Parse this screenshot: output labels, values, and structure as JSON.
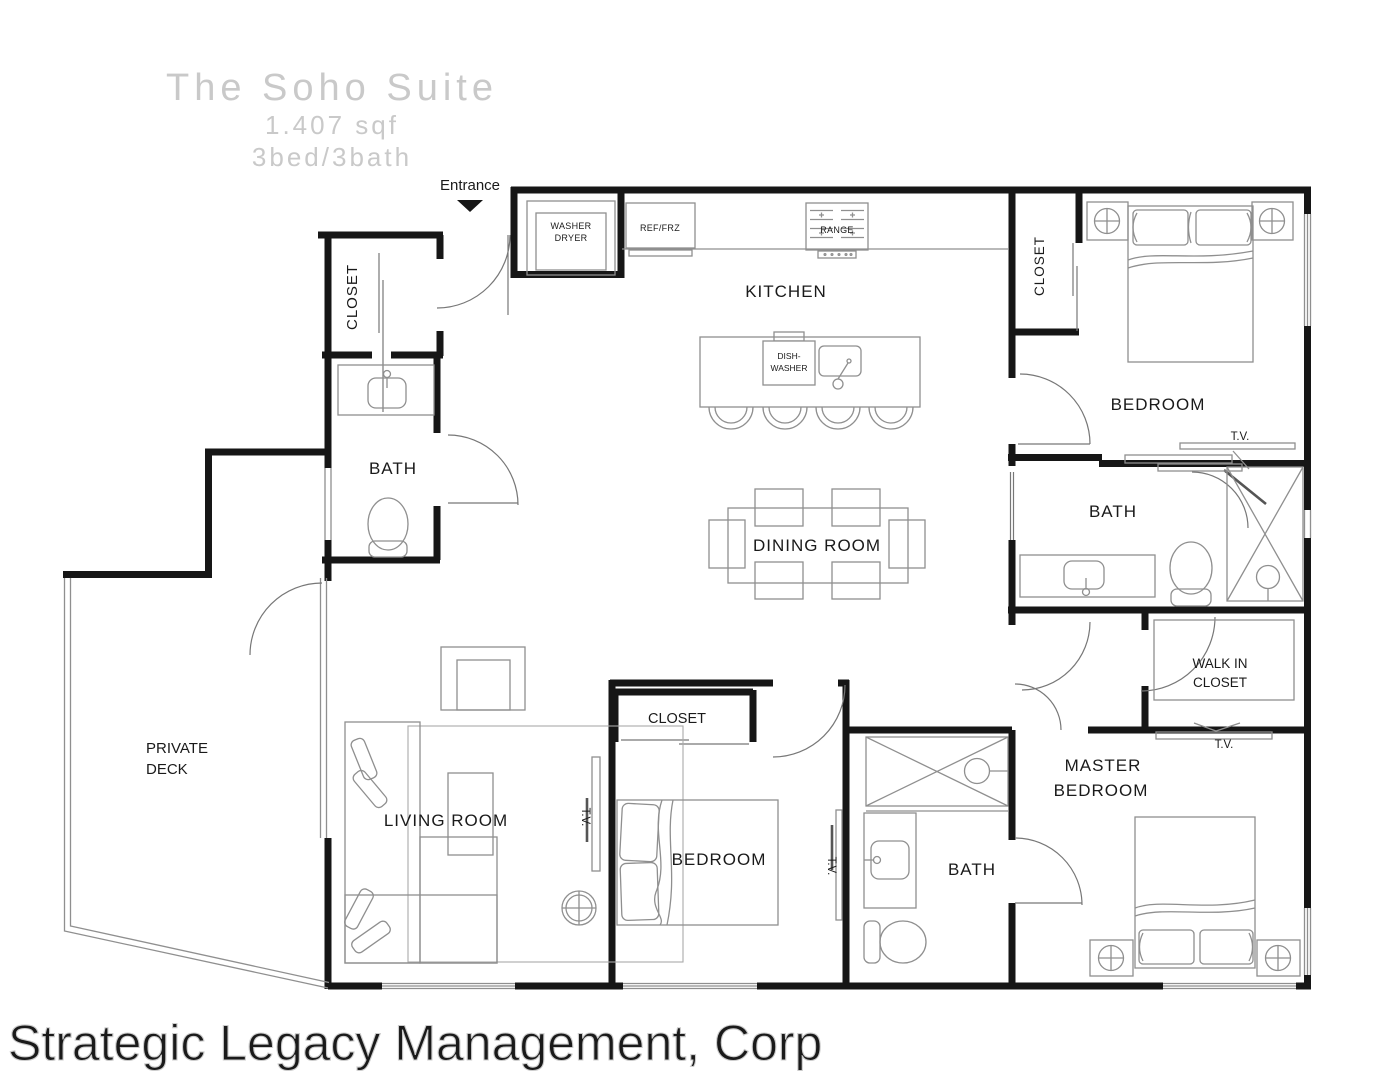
{
  "title": {
    "name": "The Soho Suite",
    "area": "1.407 sqf",
    "beds": "3bed/3bath"
  },
  "entrance_label": "Entrance",
  "watermark": "Strategic Legacy Management, Corp",
  "rooms": {
    "kitchen": "KITCHEN",
    "dining": "DINING ROOM",
    "living": "LIVING ROOM",
    "bedroom_top": "BEDROOM",
    "bedroom_bottom": "BEDROOM",
    "master_line1": "MASTER",
    "master_line2": "BEDROOM",
    "bath_entry": "BATH",
    "bath_guest": "BATH",
    "bath_master": "BATH",
    "closet_entry": "CLOSET",
    "closet_bedroom_top": "CLOSET",
    "closet_bedroom_bottom": "CLOSET",
    "walkin_line1": "WALK IN",
    "walkin_line2": "CLOSET",
    "deck_line1": "PRIVATE",
    "deck_line2": "DECK"
  },
  "fixtures": {
    "washer_line1": "WASHER",
    "washer_line2": "DRYER",
    "ref": "REF/FRZ",
    "range": "RANGE",
    "dishwasher_line1": "DISH-",
    "dishwasher_line2": "WASHER",
    "tv": "T.V."
  },
  "colors": {
    "wall": "#161616",
    "furniture": "#8f8f8f",
    "label": "#1a1a1a",
    "title_gray": "#c9c9c9",
    "watermark_fill": "#f7f7f7",
    "watermark_stroke": "#cccccc"
  }
}
